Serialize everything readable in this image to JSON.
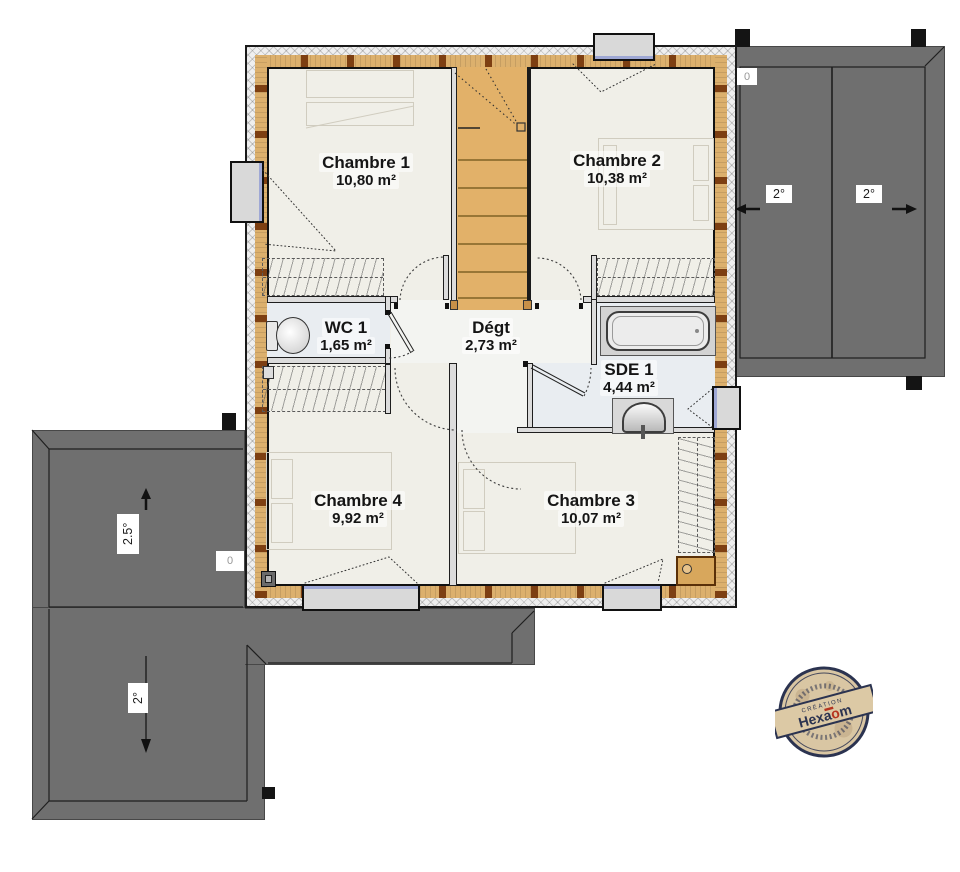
{
  "plan": {
    "rooms": [
      {
        "name": "Chambre 1",
        "area": "10,80 m²"
      },
      {
        "name": "Chambre 2",
        "area": "10,38 m²"
      },
      {
        "name": "WC 1",
        "area": "1,65 m²"
      },
      {
        "name": "Dégt",
        "area": "2,73 m²"
      },
      {
        "name": "SDE 1",
        "area": "4,44 m²"
      },
      {
        "name": "Chambre 4",
        "area": "9,92 m²"
      },
      {
        "name": "Chambre 3",
        "area": "10,07 m²"
      }
    ]
  },
  "roof": {
    "slope_right_a": "2°",
    "slope_right_b": "2°",
    "slope_left_upper": "2.5°",
    "slope_left_lower": "2°",
    "marker_top_right": "0",
    "marker_left": "0"
  },
  "stamp": {
    "creation": "CRÉATION",
    "brand_prefix": "Hexa",
    "brand_accent": "o",
    "brand_suffix": "m"
  },
  "colors": {
    "wall_wood": "#dcb06d",
    "wall_block": "#7d3f12",
    "roof_gray": "#6f6f6f",
    "stairs": "#e2b169",
    "wet_floor": "#e9edf1",
    "floor": "#f0efe8",
    "window_line": "#9fa8d5",
    "stamp_navy": "#2b3350",
    "stamp_red": "#b5341f",
    "stamp_paper": "#d9c6a3"
  }
}
